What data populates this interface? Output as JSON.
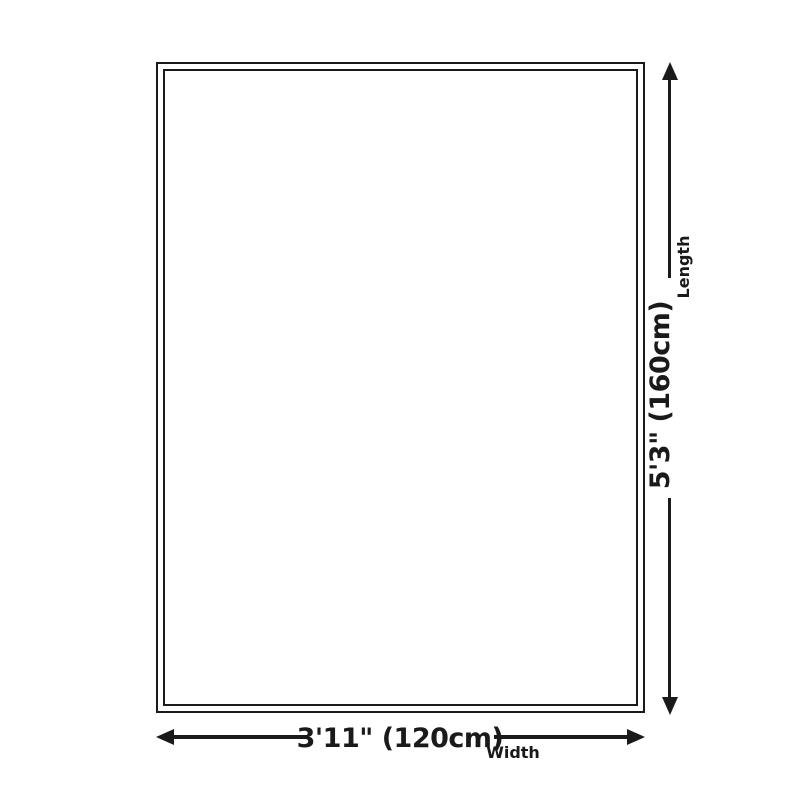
{
  "diagram": {
    "title": "rug-size-dimension-diagram",
    "length": {
      "value": "5'3\" (160cm)",
      "label": "Length"
    },
    "width": {
      "value": "3'11\" (120cm)",
      "label": "Width"
    },
    "colors": {
      "line": "#1a1a1a",
      "background": "#ffffff"
    }
  }
}
